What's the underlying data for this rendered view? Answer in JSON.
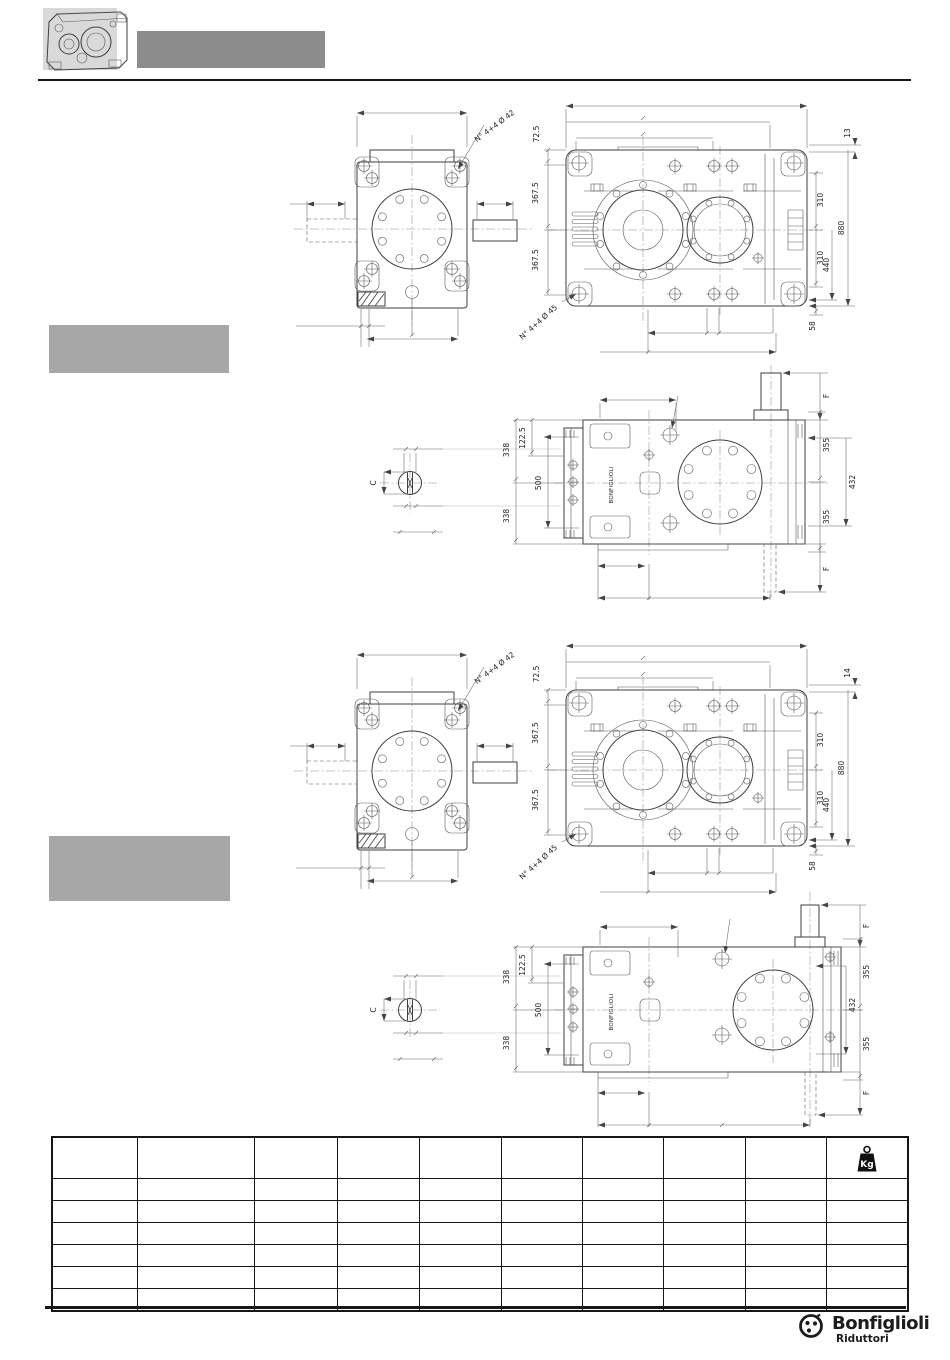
{
  "drawings": {
    "set1": {
      "front": {
        "bolt_note": "N° 4+4 Ø 42"
      },
      "plan": {
        "dim_72_5": "72.5",
        "dim_367_5_a": "367.5",
        "dim_367_5_b": "367.5",
        "dim_offset": "13",
        "dim_310_a": "310",
        "dim_880": "880",
        "dim_310_b": "310",
        "dim_440": "440",
        "dim_58": "58",
        "bolt_note": "N° 4+4 Ø 45"
      },
      "side": {
        "dim_338_a": "338",
        "dim_122_5": "122.5",
        "dim_500": "500",
        "dim_338_b": "338",
        "dim_f_top": "F",
        "dim_355_a": "355",
        "dim_432": "432",
        "dim_355_b": "355",
        "dim_f_bottom": "F",
        "section_label": "C",
        "nameplate": "BONFIGLIOLI"
      }
    },
    "set2": {
      "front": {
        "bolt_note": "N° 4+4 Ø 42"
      },
      "plan": {
        "dim_72_5": "72.5",
        "dim_367_5_a": "367.5",
        "dim_367_5_b": "367.5",
        "dim_offset": "14",
        "dim_310_a": "310",
        "dim_880": "880",
        "dim_310_b": "310",
        "dim_440": "440",
        "dim_58": "58",
        "bolt_note": "N° 4+4 Ø 45"
      },
      "side": {
        "dim_338_a": "338",
        "dim_122_5": "122.5",
        "dim_500": "500",
        "dim_338_b": "338",
        "dim_f_top": "F",
        "dim_355_a": "355",
        "dim_432": "432",
        "dim_355_b": "355",
        "dim_f_bottom": "F",
        "section_label": "C",
        "nameplate": "BONFIGLIOLI"
      }
    }
  },
  "table": {
    "columns": 10,
    "body_rows": 6,
    "weight_unit": "Kg"
  },
  "footer": {
    "brand": "Bonfiglioli",
    "division": "Riduttori"
  }
}
